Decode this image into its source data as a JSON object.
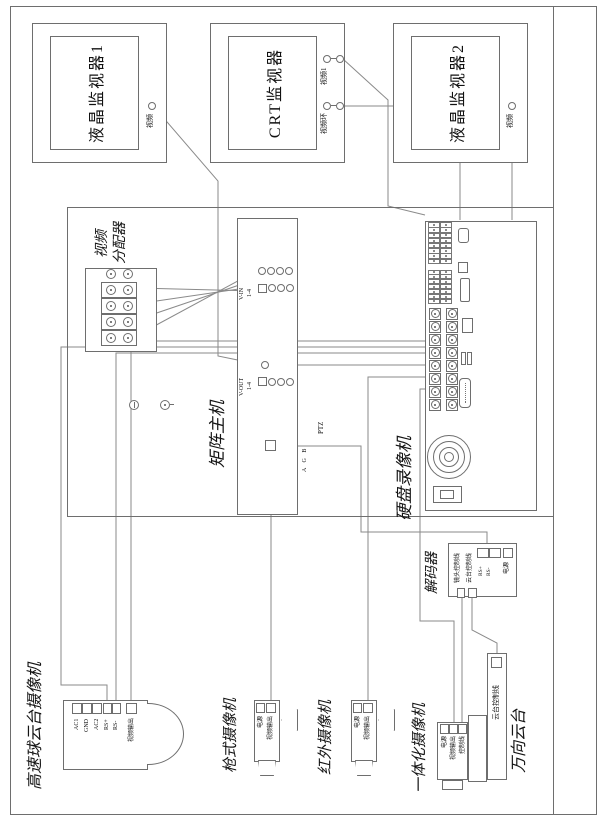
{
  "monitors": [
    {
      "label": "液晶监视器1",
      "ports": [
        {
          "label": "视频"
        }
      ]
    },
    {
      "label": "CRT监视器",
      "ports": [
        {
          "label": "视频1"
        },
        {
          "label": "视频环"
        }
      ]
    },
    {
      "label": "液晶监视器2",
      "ports": [
        {
          "label": "视频"
        }
      ]
    }
  ],
  "distributor": {
    "label_line1": "视频",
    "label_line2": "分配器"
  },
  "matrix": {
    "label": "矩阵主机",
    "v_in": "V-IN",
    "v_in_range": "1-4",
    "v_out": "V-OUT",
    "v_out_range": "1-4",
    "ptz": "PTZ",
    "abg": "A G B"
  },
  "dvr": {
    "label": "硬盘录像机"
  },
  "decoder": {
    "label": "解码器",
    "line1": "镜头控制线",
    "line2": "云台控制线",
    "rs_plus": "RS+",
    "rs_minus": "RS-",
    "power": "电源"
  },
  "cameras": {
    "dome": {
      "label": "高速球云台摄像机",
      "terminals": [
        "AC1",
        "GND",
        "AC2",
        "RS+",
        "RS-",
        "视频输出"
      ]
    },
    "gun": {
      "label": "枪式摄像机",
      "terminals": [
        "电源",
        "视频输出"
      ]
    },
    "ir": {
      "label": "红外摄像机",
      "terminals": [
        "电源",
        "视频输出"
      ]
    },
    "integrated": {
      "label": "一体化摄像机",
      "terminals": [
        "电源",
        "视频输出",
        "控制线"
      ]
    },
    "pantilt": {
      "label": "万向云台",
      "terminal": "云台控制线"
    }
  }
}
